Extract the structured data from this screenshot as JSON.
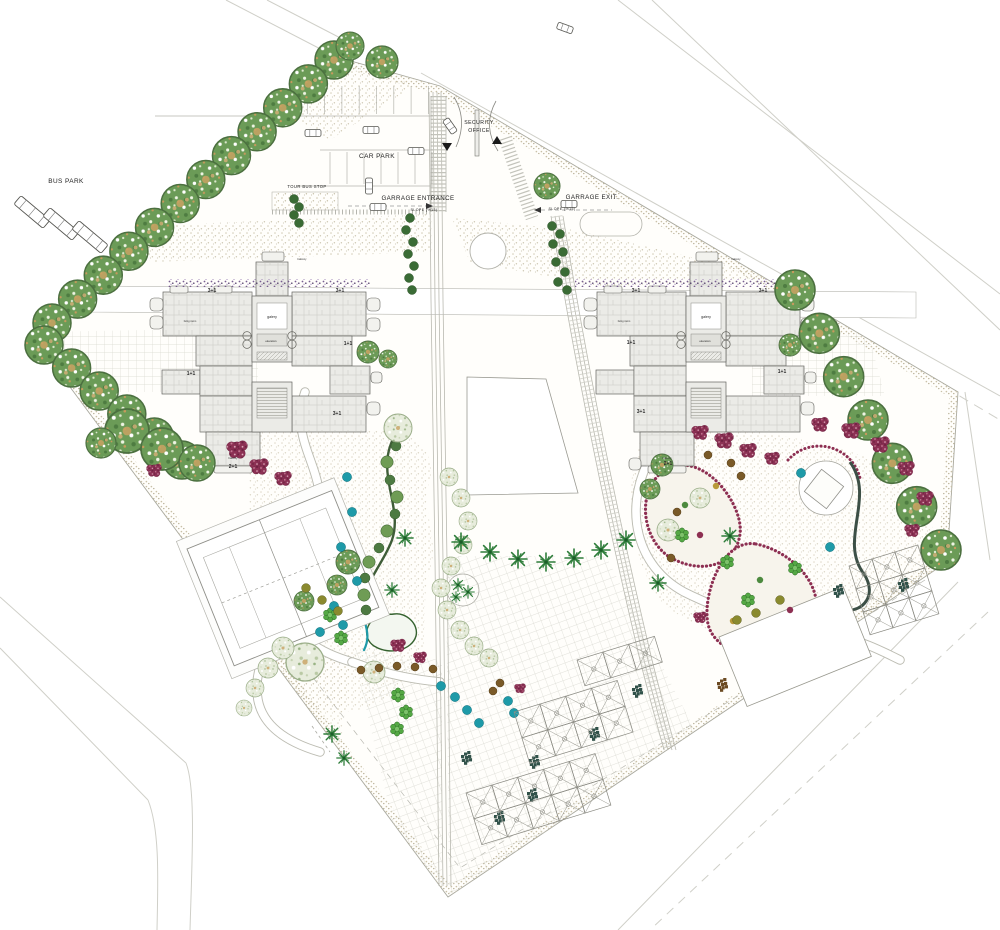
{
  "labels": {
    "bus_park": "BUS PARK",
    "car_park": "CAR PARK",
    "tour_bus_stop": "TOUR BUS STOP",
    "garage_entrance": "GARRAGE ENTRANCE",
    "slope_entrance": "SLOPE (%15)",
    "garage_exit": "GARRAGE EXIT.",
    "slope_exit": "SLOPE (%15)",
    "security_line1": "SECURITY",
    "security_line2": "OFFICE",
    "galery_left": "galery",
    "elevators_left": "elevators",
    "galery_right": "galery",
    "elevators_right": "elevators"
  },
  "unit_labels": {
    "left": [
      [
        "3+1",
        212,
        292
      ],
      [
        "3+1",
        340,
        292
      ],
      [
        "1+1",
        348,
        345
      ],
      [
        "1+1",
        191,
        375
      ],
      [
        "3+1",
        337,
        415
      ],
      [
        "2+1",
        233,
        468
      ]
    ],
    "right": [
      [
        "3+1",
        636,
        292
      ],
      [
        "3+1",
        763,
        292
      ],
      [
        "1+1",
        631,
        344
      ],
      [
        "1+1",
        782,
        373
      ],
      [
        "3+1",
        641,
        413
      ],
      [
        "2+1",
        668,
        465
      ]
    ]
  },
  "room_labels": [
    [
      "balcony",
      302,
      260
    ],
    [
      "balcony",
      233,
      459
    ],
    [
      "balcony",
      736,
      260
    ],
    [
      "balcony",
      667,
      459
    ],
    [
      "living room",
      190,
      322
    ],
    [
      "living room",
      624,
      322
    ]
  ],
  "colors": {
    "tree_green": "#6b9b57",
    "tree_pale": "#e7ecdc",
    "burgundy": "#8d2f52",
    "teal": "#1e9aa8",
    "olive": "#8a8a2f",
    "brown": "#7a5a28",
    "dark_cluster": "#31524a",
    "brown_cluster": "#6b4a22",
    "purple_hedge": "#6a4d86",
    "bright_green": "#54a844",
    "palm_green": "#2e7d3a"
  },
  "tree_rows": [
    {
      "x1": 334,
      "y1": 60,
      "x2": 52,
      "y2": 323,
      "n": 12,
      "r": 19
    },
    {
      "x1": 44,
      "y1": 345,
      "x2": 182,
      "y2": 460,
      "n": 6,
      "r": 19
    },
    {
      "x1": 795,
      "y1": 290,
      "x2": 941,
      "y2": 550,
      "n": 7,
      "r": 20
    }
  ],
  "trees_green": [
    [
      382,
      62,
      16
    ],
    [
      350,
      46,
      14
    ],
    [
      547,
      186,
      13
    ],
    [
      368,
      352,
      11
    ],
    [
      388,
      359,
      9
    ],
    [
      790,
      345,
      11
    ],
    [
      127,
      431,
      22
    ],
    [
      162,
      449,
      21
    ],
    [
      197,
      463,
      18
    ],
    [
      101,
      443,
      15
    ],
    [
      348,
      562,
      12
    ],
    [
      337,
      585,
      10
    ],
    [
      304,
      601,
      10
    ],
    [
      662,
      465,
      11
    ],
    [
      650,
      489,
      10
    ]
  ],
  "trees_pale": [
    [
      398,
      428,
      14
    ],
    [
      305,
      662,
      19
    ],
    [
      374,
      672,
      11
    ],
    [
      283,
      648,
      11
    ],
    [
      268,
      668,
      10
    ],
    [
      255,
      688,
      9
    ],
    [
      244,
      708,
      8
    ],
    [
      668,
      530,
      11
    ],
    [
      700,
      498,
      10
    ]
  ],
  "scallop_chain": [
    [
      449,
      477
    ],
    [
      461,
      498
    ],
    [
      468,
      521
    ],
    [
      463,
      545
    ],
    [
      451,
      566
    ],
    [
      441,
      588
    ],
    [
      447,
      610
    ],
    [
      460,
      630
    ],
    [
      474,
      646
    ],
    [
      489,
      658
    ]
  ],
  "hedge_dots": [
    [
      396,
      446
    ],
    [
      387,
      462
    ],
    [
      390,
      480
    ],
    [
      397,
      497
    ],
    [
      395,
      514
    ],
    [
      387,
      531
    ],
    [
      379,
      548
    ],
    [
      369,
      562
    ],
    [
      365,
      578
    ],
    [
      364,
      595
    ],
    [
      366,
      610
    ]
  ],
  "trees_burgundy": [
    [
      237,
      449,
      1.1
    ],
    [
      259,
      466,
      1
    ],
    [
      283,
      478,
      0.9
    ],
    [
      700,
      432,
      0.9
    ],
    [
      724,
      440,
      1
    ],
    [
      748,
      450,
      0.9
    ],
    [
      772,
      458,
      0.8
    ],
    [
      820,
      424,
      0.9
    ],
    [
      851,
      430,
      1
    ],
    [
      880,
      444,
      1
    ],
    [
      906,
      468,
      0.9
    ],
    [
      925,
      498,
      0.9
    ],
    [
      912,
      530,
      0.8
    ],
    [
      398,
      645,
      0.8
    ],
    [
      420,
      657,
      0.7
    ],
    [
      700,
      617,
      0.7
    ],
    [
      520,
      688,
      0.6
    ],
    [
      154,
      470,
      0.8
    ]
  ],
  "bright_shrubs": [
    [
      398,
      695
    ],
    [
      406,
      712
    ],
    [
      397,
      729
    ],
    [
      330,
      615
    ],
    [
      341,
      638
    ],
    [
      682,
      535
    ],
    [
      727,
      562
    ],
    [
      795,
      568
    ],
    [
      748,
      600
    ]
  ],
  "dots_teal": [
    [
      347,
      477
    ],
    [
      352,
      512
    ],
    [
      341,
      547
    ],
    [
      357,
      581
    ],
    [
      334,
      606
    ],
    [
      320,
      632
    ],
    [
      343,
      625
    ],
    [
      455,
      697
    ],
    [
      467,
      710
    ],
    [
      479,
      723
    ],
    [
      441,
      686
    ],
    [
      801,
      473
    ],
    [
      830,
      547
    ],
    [
      508,
      701
    ],
    [
      514,
      713
    ]
  ],
  "dots_olive": [
    [
      306,
      588
    ],
    [
      322,
      600
    ],
    [
      338,
      611
    ],
    [
      737,
      620
    ],
    [
      756,
      613
    ],
    [
      780,
      600
    ]
  ],
  "dots_brown": [
    [
      361,
      670
    ],
    [
      379,
      668
    ],
    [
      397,
      666
    ],
    [
      415,
      667
    ],
    [
      433,
      669
    ],
    [
      708,
      455
    ],
    [
      731,
      463
    ],
    [
      677,
      512
    ],
    [
      671,
      558
    ],
    [
      500,
      683
    ],
    [
      493,
      691
    ],
    [
      741,
      476
    ]
  ],
  "bed_dots": [
    [
      685,
      505
    ],
    [
      700,
      535
    ],
    [
      716,
      486
    ],
    [
      760,
      580
    ],
    [
      790,
      610
    ],
    [
      733,
      621
    ]
  ],
  "bed_dot_colors": [
    "#4d8a3f",
    "#8d2f52",
    "#b89a3a"
  ],
  "palms": [
    [
      461,
      542,
      1
    ],
    [
      490,
      552,
      1
    ],
    [
      518,
      559,
      1
    ],
    [
      546,
      562,
      1
    ],
    [
      574,
      558,
      1
    ],
    [
      601,
      550,
      1
    ],
    [
      626,
      540,
      1
    ],
    [
      405,
      538,
      0.9
    ],
    [
      458,
      585,
      0.7
    ],
    [
      468,
      592,
      0.7
    ],
    [
      456,
      597,
      0.6
    ],
    [
      392,
      590,
      0.8
    ],
    [
      332,
      734,
      0.9
    ],
    [
      344,
      758,
      0.8
    ],
    [
      658,
      583,
      0.9
    ],
    [
      730,
      536,
      0.9
    ]
  ],
  "clusters_dark": [
    [
      637,
      690
    ],
    [
      594,
      733
    ],
    [
      534,
      761
    ],
    [
      532,
      794
    ],
    [
      499,
      817
    ],
    [
      466,
      757
    ],
    [
      838,
      590
    ],
    [
      903,
      584
    ]
  ],
  "clusters_brown": [
    [
      722,
      684
    ]
  ],
  "shrub_chains": [
    [
      [
        410,
        218
      ],
      [
        406,
        230
      ],
      [
        413,
        242
      ],
      [
        408,
        254
      ],
      [
        414,
        266
      ],
      [
        409,
        278
      ],
      [
        412,
        290
      ]
    ],
    [
      [
        552,
        226
      ],
      [
        560,
        234
      ],
      [
        553,
        244
      ],
      [
        563,
        252
      ],
      [
        556,
        262
      ],
      [
        565,
        272
      ],
      [
        558,
        282
      ],
      [
        567,
        290
      ]
    ],
    [
      [
        294,
        199
      ],
      [
        299,
        207
      ],
      [
        294,
        215
      ],
      [
        299,
        223
      ]
    ]
  ],
  "pergola_grids": [
    {
      "x": 466,
      "y": 793,
      "cols": 5,
      "rows": 2,
      "cell": 27
    },
    {
      "x": 514,
      "y": 712,
      "cols": 4,
      "rows": 2,
      "cell": 27
    },
    {
      "x": 577,
      "y": 660,
      "cols": 3,
      "rows": 1,
      "cell": 27
    },
    {
      "x": 849,
      "y": 566,
      "cols": 3,
      "rows": 3,
      "cell": 24
    }
  ],
  "pergola_angle": -17,
  "vehicles": {
    "cars": [
      [
        313,
        133,
        0
      ],
      [
        371,
        130,
        0
      ],
      [
        416,
        151,
        0
      ],
      [
        369,
        186,
        90
      ],
      [
        378,
        207,
        0
      ],
      [
        450,
        126,
        55
      ],
      [
        569,
        204,
        0
      ],
      [
        565,
        28,
        20
      ]
    ],
    "buses": [
      [
        32,
        212,
        40
      ],
      [
        61,
        224,
        40
      ],
      [
        90,
        237,
        40
      ]
    ]
  },
  "parking_ticks": [
    {
      "x0": 290,
      "step": 17.3,
      "n": 9,
      "y1": 86,
      "y2": 114
    },
    {
      "x0": 330,
      "step": 17,
      "n": 7,
      "y1": 152,
      "y2": 184
    }
  ]
}
